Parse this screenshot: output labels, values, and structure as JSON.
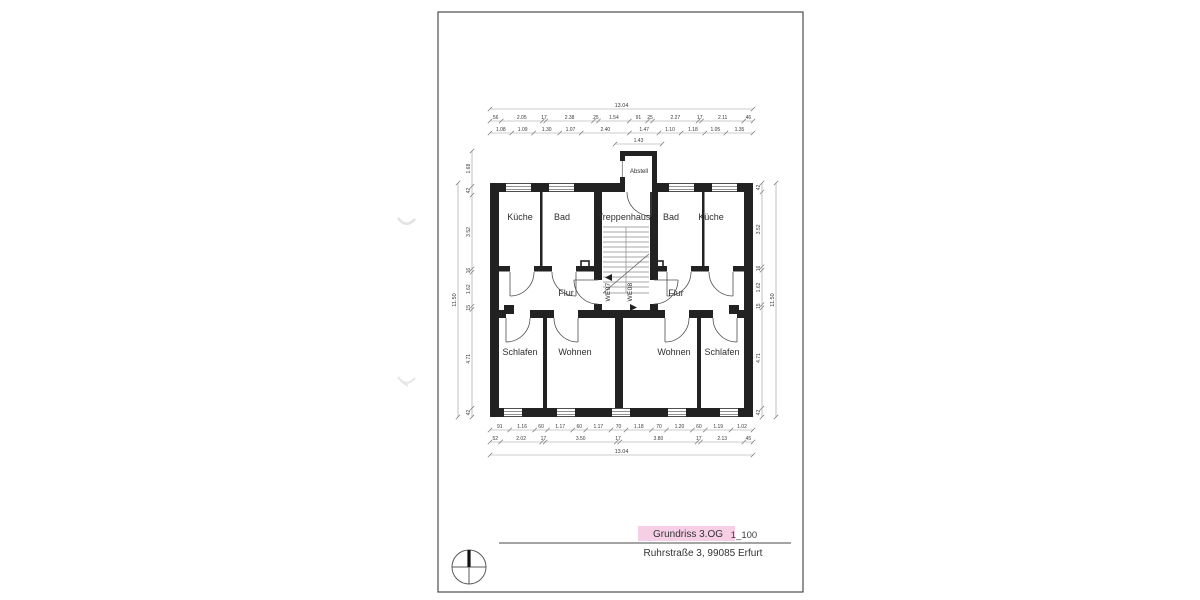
{
  "sheet": {
    "title_label": "Grundriss 3.OG",
    "scale_label": "1_100",
    "address": "Ruhrstraße 3, 99085 Erfurt"
  },
  "rooms": {
    "abstell": "Abstell",
    "kueche_left": "Küche",
    "bad_left": "Bad",
    "treppenhaus": "Treppenhaus",
    "bad_right": "Bad",
    "kueche_right": "Küche",
    "flur_left": "Flur",
    "flur_right": "Flur",
    "we07": "WE07",
    "we08": "WE08",
    "schlafen_left": "Schlafen",
    "wohnen_left": "Wohnen",
    "wohnen_right": "Wohnen",
    "schlafen_right": "Schlafen"
  },
  "dimensions": {
    "top": {
      "overall": [
        "13.04"
      ],
      "row1": [
        "56",
        "2.05",
        "17",
        "2.38",
        "25",
        "1.54",
        "91",
        "25",
        "2.27",
        "17",
        "2.11",
        "46"
      ],
      "row2": [
        "1.08",
        "1.09",
        "1.30",
        "1.07",
        "2.40",
        "1.47",
        "1.10",
        "1.18",
        "1.05",
        "1.35"
      ],
      "abstell_width": [
        "1.43"
      ]
    },
    "bottom": {
      "row1": [
        "91",
        "1.16",
        "60",
        "1.17",
        "60",
        "1.17",
        "70",
        "1.18",
        "70",
        "1.20",
        "60",
        "1.19",
        "1.02"
      ],
      "row2": [
        "52",
        "2.02",
        "17",
        "3.50",
        "17",
        "3.80",
        "17",
        "2.13",
        "45"
      ],
      "overall": [
        "13.04"
      ]
    },
    "left": {
      "row1": [
        "1.68",
        "42",
        "3.52",
        "16",
        "1.62",
        "15",
        "4.71",
        "42"
      ],
      "overall": [
        "11.50"
      ]
    },
    "right": {
      "row1": [
        "42",
        "3.52",
        "16",
        "1.62",
        "15",
        "4.71",
        "42"
      ],
      "overall": [
        "11.50"
      ]
    }
  },
  "icons": {
    "north_indicator": "compass-cross-icon",
    "we07_direction": "left-triangle-icon",
    "we08_direction": "right-triangle-icon"
  },
  "colors": {
    "wall_black": "#222222",
    "dim_line_gray": "#999999",
    "highlight_pink": "#f6cfe7",
    "sheet_border": "#3c3c3c"
  }
}
